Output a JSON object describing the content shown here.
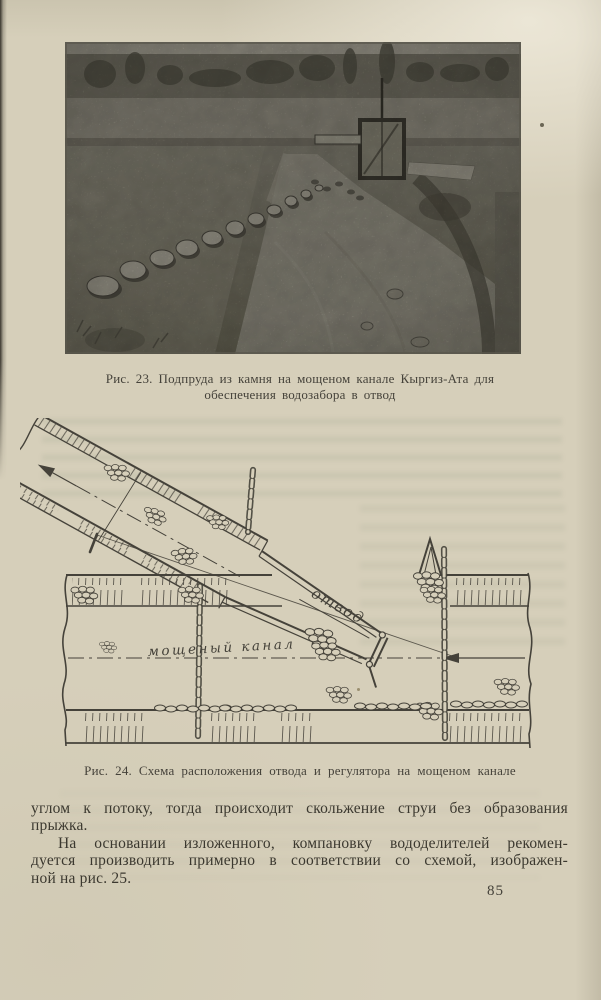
{
  "page_number": "85",
  "figure23": {
    "caption_line1": "Рис. 23. Подпруда из камня на  мощеном канале  Кыргиз-Ата  для",
    "caption_line2": "обеспечения  водозабора в отвод"
  },
  "figure24": {
    "caption": "Рис. 24. Схема  расположения отвода и регулятора на мощеном канале",
    "label_otvod": "отвод",
    "label_channel": "мощеный канал"
  },
  "body_text": {
    "line1": "углом к потоку, тогда происходит скольжение струи без образования",
    "line2": "прыжка.",
    "line3": "На основании изложенного, компановку вододелителей рекомен-",
    "line4": "дуется производить примерно в соответствии со схемой, изображен-",
    "line5": "ной на рис. 25."
  },
  "colors": {
    "paper": "#d6cfba",
    "ink": "#45423a",
    "photo_base": "#8f8c7e"
  }
}
